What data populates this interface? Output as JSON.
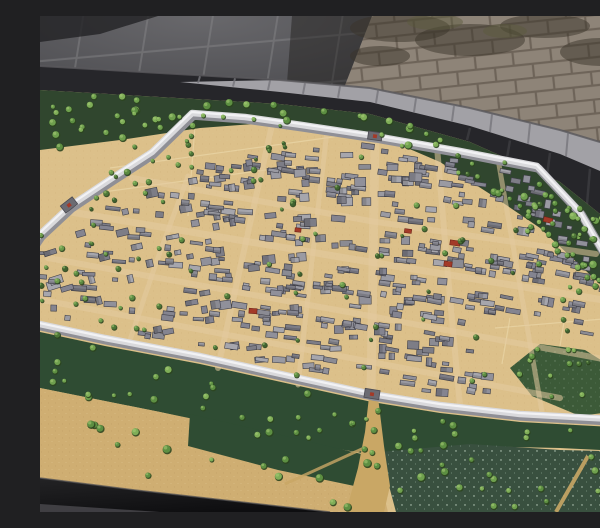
{
  "scene": {
    "subject": "Museum exhibit photo: miniature scale model of an ancient walled city on a display table beside a stone-brick wall",
    "elements": [
      "museum-floor",
      "stone-brick-wall",
      "table-ledge",
      "table-side",
      "city-model",
      "city-wall",
      "city-gates",
      "streets",
      "buildings",
      "trees",
      "fields",
      "moat-water",
      "south-road",
      "table-front-edge"
    ]
  },
  "palette": {
    "floor": "#47474b",
    "floorJoint": "#707073",
    "floorShadow": "#222224",
    "floorGlow": "#8a898c",
    "brick": "#8e8478",
    "brickMortar": "#6e6459",
    "brickShade": "#39332a",
    "brickMoss": "#5a5c3c",
    "ledge": "#a2a1a6",
    "ledgeJoint": "#77767c",
    "darkEdge": "#26262a",
    "darkEdgeDeep": "#161618",
    "sand": "#dcc08a",
    "sandSpeck": "#b9975d",
    "fieldTan": "#cfae72",
    "greenDark": "#30462e",
    "greenMid": "#3c5a38",
    "greenField": "#2f4c33",
    "water": "#39503f",
    "sparkle": "#d8ead8",
    "wall": "#d9d9dc",
    "wallShadow": "#8f8f96",
    "wallHighlight": "#f2f2f4",
    "road": "#c9a765",
    "streetHint": "#e3caa0",
    "gate": "#6b6b72",
    "roofRed": "#a33a28",
    "buildingGrays": [
      "#9a9aa2",
      "#8b8b93",
      "#a6a6ad",
      "#7d7d86",
      "#90909a",
      "#848490"
    ],
    "buildingStroke": "#3f3f48",
    "treeGreens": [
      "#5b8a41",
      "#4c7637",
      "#6b9a4b",
      "#3f6330"
    ],
    "treeLightGreens": [
      "#6fa04e",
      "#7fae58",
      "#5d8f42"
    ],
    "treeDark": "#2c451f",
    "treeHighlight": "#a9cc78",
    "black": "#1b1b1d",
    "cornerSliver": "#454448"
  },
  "geometry": {
    "view": [
      600,
      496
    ],
    "brickPoly": [
      [
        332,
        0
      ],
      [
        600,
        0
      ],
      [
        600,
        138
      ],
      [
        302,
        77
      ]
    ],
    "brickShadeSpots": [
      [
        360,
        12,
        50,
        14
      ],
      [
        430,
        24,
        55,
        16
      ],
      [
        505,
        10,
        45,
        12
      ],
      [
        560,
        36,
        40,
        14
      ],
      [
        340,
        40,
        30,
        10
      ]
    ],
    "brickMossSpots": [
      [
        395,
        6,
        28,
        8
      ],
      [
        465,
        15,
        22,
        7
      ]
    ],
    "floorShadowNearBricks": [
      [
        246,
        80
      ],
      [
        302,
        77
      ],
      [
        332,
        0
      ],
      [
        252,
        0
      ]
    ],
    "floorCornerShadow": [
      [
        0,
        0
      ],
      [
        118,
        0
      ],
      [
        60,
        18
      ],
      [
        0,
        26
      ]
    ],
    "lineA": [
      [
        0,
        50
      ],
      [
        240,
        64
      ],
      [
        330,
        72
      ],
      [
        430,
        92
      ],
      [
        520,
        114
      ],
      [
        600,
        138
      ]
    ],
    "ledgeBottom": [
      [
        140,
        66
      ],
      [
        240,
        76
      ],
      [
        330,
        86
      ],
      [
        430,
        110
      ],
      [
        520,
        138
      ],
      [
        600,
        172
      ]
    ],
    "lineB": [
      [
        0,
        74
      ],
      [
        240,
        88
      ],
      [
        330,
        98
      ],
      [
        430,
        126
      ],
      [
        520,
        166
      ],
      [
        600,
        230
      ]
    ],
    "ledgeTickXs": [
      160,
      195,
      230,
      265,
      300,
      338,
      376,
      414,
      452,
      490,
      528,
      566,
      592
    ],
    "darkTickXs": [
      430,
      470,
      510,
      550,
      588
    ],
    "greenNorth": [
      [
        0,
        74
      ],
      [
        240,
        88
      ],
      [
        330,
        98
      ],
      [
        430,
        126
      ],
      [
        520,
        166
      ],
      [
        600,
        230
      ],
      [
        600,
        312
      ],
      [
        560,
        268
      ],
      [
        500,
        212
      ],
      [
        450,
        178
      ],
      [
        400,
        146
      ],
      [
        330,
        116
      ],
      [
        240,
        106
      ],
      [
        160,
        112
      ],
      [
        80,
        124
      ],
      [
        0,
        134
      ]
    ],
    "greenSouth": [
      [
        0,
        316
      ],
      [
        65,
        330
      ],
      [
        160,
        348
      ],
      [
        250,
        368
      ],
      [
        332,
        386
      ],
      [
        400,
        397
      ],
      [
        480,
        406
      ],
      [
        591,
        412
      ],
      [
        600,
        416
      ],
      [
        600,
        436
      ],
      [
        520,
        432
      ],
      [
        430,
        430
      ],
      [
        340,
        440
      ],
      [
        245,
        424
      ],
      [
        120,
        396
      ],
      [
        0,
        372
      ]
    ],
    "tanBL": [
      [
        0,
        372
      ],
      [
        120,
        396
      ],
      [
        245,
        422
      ],
      [
        335,
        444
      ],
      [
        348,
        496
      ],
      [
        0,
        496
      ]
    ],
    "greenBC": [
      [
        150,
        398
      ],
      [
        245,
        420
      ],
      [
        330,
        440
      ],
      [
        324,
        472
      ],
      [
        238,
        454
      ],
      [
        148,
        430
      ]
    ],
    "water1": [
      [
        340,
        436
      ],
      [
        430,
        428
      ],
      [
        520,
        434
      ],
      [
        600,
        436
      ],
      [
        600,
        496
      ],
      [
        356,
        496
      ]
    ],
    "pondSE": [
      [
        500,
        328
      ],
      [
        545,
        334
      ],
      [
        580,
        356
      ],
      [
        585,
        394
      ],
      [
        540,
        400
      ],
      [
        492,
        380
      ],
      [
        470,
        352
      ]
    ],
    "road": [
      [
        329,
        381
      ],
      [
        338,
        381
      ],
      [
        344,
        430
      ],
      [
        350,
        470
      ],
      [
        344,
        496
      ],
      [
        306,
        496
      ],
      [
        318,
        452
      ],
      [
        325,
        416
      ]
    ],
    "roadBranch": [
      [
        324,
        432
      ],
      [
        245,
        468
      ]
    ],
    "ditch": [
      [
        548,
        440
      ],
      [
        516,
        496
      ]
    ],
    "fieldLines": [
      [
        [
          70,
          152
        ],
        [
          300,
          120
        ]
      ],
      [
        [
          48,
          178
        ],
        [
          255,
          150
        ]
      ],
      [
        [
          155,
          110
        ],
        [
          148,
          200
        ]
      ],
      [
        [
          455,
          312
        ],
        [
          575,
          302
        ]
      ],
      [
        [
          470,
          302
        ],
        [
          462,
          348
        ]
      ],
      [
        [
          525,
          300
        ],
        [
          520,
          330
        ]
      ]
    ],
    "wall": [
      [
        -30,
        262
      ],
      [
        0,
        218
      ],
      [
        30,
        190
      ],
      [
        72,
        162
      ],
      [
        112,
        136
      ],
      [
        152,
        97
      ],
      [
        205,
        101
      ],
      [
        262,
        109
      ],
      [
        335,
        120
      ],
      [
        420,
        135
      ],
      [
        497,
        150
      ],
      [
        540,
        196
      ],
      [
        568,
        244
      ],
      [
        585,
        300
      ],
      [
        594,
        352
      ],
      [
        591,
        404
      ],
      [
        480,
        398
      ],
      [
        400,
        389
      ],
      [
        332,
        378
      ],
      [
        250,
        360
      ],
      [
        160,
        340
      ],
      [
        65,
        322
      ],
      [
        0,
        308
      ]
    ],
    "gates": [
      {
        "x": 29,
        "y": 189,
        "a": -38,
        "w": 15,
        "h": 9
      },
      {
        "x": 335,
        "y": 120,
        "a": 8,
        "w": 14,
        "h": 8
      },
      {
        "x": 332,
        "y": 378,
        "a": 9,
        "w": 15,
        "h": 9
      },
      {
        "x": 589,
        "y": 285,
        "a": 72,
        "w": 12,
        "h": 7
      }
    ],
    "streets": [
      {
        "pts": [
          [
            335,
            123
          ],
          [
            333,
            250
          ],
          [
            331,
            377
          ]
        ],
        "w": 9
      },
      {
        "pts": [
          [
            31,
            196
          ],
          [
            330,
            246
          ],
          [
            588,
            288
          ]
        ],
        "w": 7
      },
      {
        "pts": [
          [
            8,
            242
          ],
          [
            330,
            300
          ],
          [
            590,
            348
          ]
        ],
        "w": 6
      },
      {
        "pts": [
          [
            2,
            284
          ],
          [
            300,
            340
          ],
          [
            520,
            382
          ]
        ],
        "w": 6
      },
      {
        "pts": [
          [
            92,
            162
          ],
          [
            330,
            205
          ],
          [
            556,
            238
          ]
        ],
        "w": 6
      },
      {
        "pts": [
          [
            232,
            109
          ],
          [
            205,
            230
          ],
          [
            178,
            352
          ]
        ],
        "w": 6
      },
      {
        "pts": [
          [
            287,
            115
          ],
          [
            272,
            245
          ],
          [
            258,
            369
          ]
        ],
        "w": 5
      },
      {
        "pts": [
          [
            397,
            131
          ],
          [
            408,
            260
          ],
          [
            420,
            390
          ]
        ],
        "w": 6
      },
      {
        "pts": [
          [
            458,
            143
          ],
          [
            480,
            270
          ],
          [
            502,
            396
          ]
        ],
        "w": 5
      },
      {
        "pts": [
          [
            148,
            160
          ],
          [
            115,
            250
          ],
          [
            88,
            330
          ]
        ],
        "w": 5
      }
    ],
    "nwEmpty": [
      [
        38,
        202
      ],
      [
        148,
        100
      ],
      [
        332,
        102
      ],
      [
        336,
        116
      ],
      [
        160,
        150
      ],
      [
        92,
        186
      ]
    ],
    "seEmpty": [
      [
        420,
        300
      ],
      [
        585,
        300
      ],
      [
        590,
        400
      ],
      [
        480,
        395
      ],
      [
        432,
        340
      ]
    ],
    "redBuildings": [
      [
        415,
        227,
        10,
        5,
        8
      ],
      [
        408,
        248,
        8,
        5,
        8
      ],
      [
        508,
        204,
        9,
        5,
        14
      ],
      [
        368,
        215,
        7,
        4,
        8
      ],
      [
        213,
        295,
        8,
        5,
        4
      ],
      [
        258,
        214,
        6,
        4,
        6
      ]
    ],
    "blackWedge": [
      [
        0,
        462
      ],
      [
        95,
        474
      ],
      [
        290,
        496
      ],
      [
        0,
        496
      ]
    ],
    "cornerSliver": [
      [
        0,
        488
      ],
      [
        120,
        496
      ],
      [
        0,
        496
      ]
    ]
  },
  "generation": {
    "buildings": {
      "seed": 20240,
      "count": 520,
      "maxTries": 9000,
      "wallMargin": 9,
      "center": [
        325,
        252
      ]
    },
    "treeZones": [
      {
        "poly": "greenNorth",
        "n": 80,
        "r": [
          2.2,
          4.4
        ],
        "light": true
      },
      {
        "poly": [
          [
            0,
            134
          ],
          [
            150,
            112
          ],
          [
            162,
            200
          ],
          [
            20,
            212
          ]
        ],
        "n": 14,
        "r": [
          2.0,
          3.6
        ],
        "light": false
      },
      {
        "poly": [
          [
            460,
            170
          ],
          [
            600,
            250
          ],
          [
            600,
            330
          ],
          [
            470,
            232
          ]
        ],
        "n": 18,
        "r": [
          2.0,
          3.4
        ],
        "light": true
      },
      {
        "poly": "greenSouth",
        "n": 40,
        "r": [
          2.2,
          4.2
        ],
        "light": true
      },
      {
        "poly": [
          [
            0,
            400
          ],
          [
            600,
            440
          ],
          [
            600,
            492
          ],
          [
            300,
            492
          ],
          [
            0,
            460
          ]
        ],
        "n": 42,
        "r": [
          2.4,
          4.6
        ],
        "light": true
      },
      {
        "poly": [
          [
            0,
            212
          ],
          [
            42,
            232
          ],
          [
            32,
            320
          ],
          [
            0,
            318
          ]
        ],
        "n": 8,
        "r": [
          2.0,
          3.4
        ],
        "light": false
      },
      {
        "poly": "wall",
        "n": 95,
        "r": [
          1.8,
          3.2
        ],
        "light": false
      },
      {
        "poly": "pondSE",
        "n": 10,
        "r": [
          2.2,
          3.4
        ],
        "light": true
      }
    ],
    "treeRows": [
      {
        "a": [
          498,
          168
        ],
        "b": [
          592,
          260
        ],
        "n": 11,
        "r": 2.8
      },
      {
        "a": [
          478,
          188
        ],
        "b": [
          584,
          300
        ],
        "n": 12,
        "r": 2.8
      }
    ],
    "treeSeed": 777
  }
}
